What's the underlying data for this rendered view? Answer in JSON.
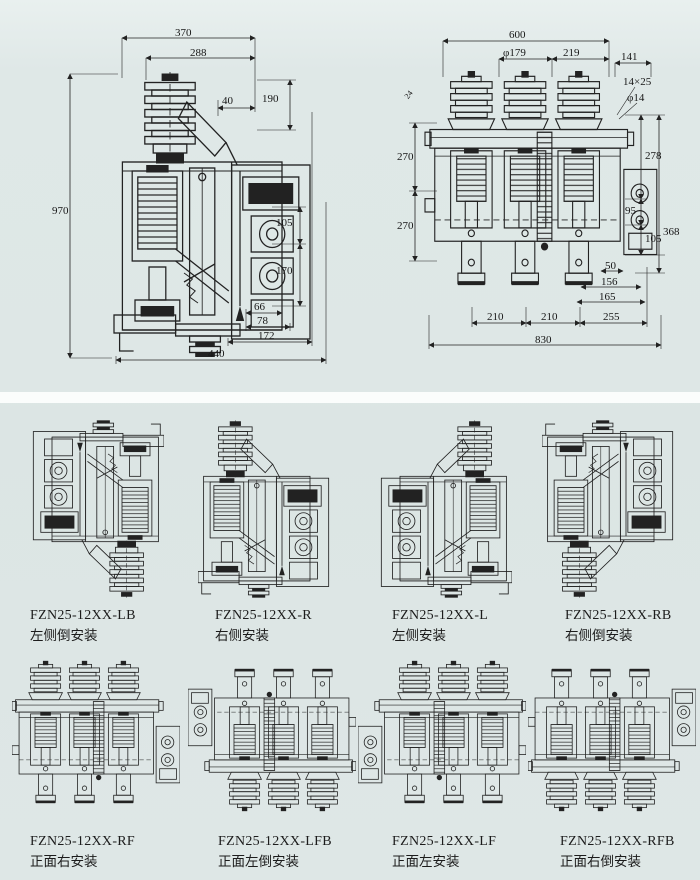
{
  "page": {
    "kind": "switchgear overall and mounting dimensions drawing"
  },
  "colors": {
    "background": "#dee7e6",
    "divider": "#fbfdfc",
    "line": "#222222"
  },
  "top": {
    "left_dims": {
      "a370": "370",
      "a288": "288",
      "a190": "190",
      "a40": "40",
      "a970": "970",
      "a105": "105",
      "a170": "170",
      "a66": "66",
      "a78": "78",
      "a172": "172",
      "a440": "440"
    },
    "right_dims": {
      "a600": "600",
      "a179": "φ179",
      "a219": "219",
      "a141": "141",
      "slot": "14×25",
      "hole": "φ14",
      "a24": "24",
      "a270a": "270",
      "a270b": "270",
      "a278": "278",
      "a95": "95",
      "a105": "105",
      "a368": "368",
      "a50": "50",
      "a156": "156",
      "a165": "165",
      "a210a": "210",
      "a210b": "210",
      "a255": "255",
      "a830": "830"
    }
  },
  "variants": {
    "side": [
      {
        "model": "FZN25-12XX-LB",
        "desc": "左侧倒安装"
      },
      {
        "model": "FZN25-12XX-R",
        "desc": "右侧安装"
      },
      {
        "model": "FZN25-12XX-L",
        "desc": "左侧安装"
      },
      {
        "model": "FZN25-12XX-RB",
        "desc": "右侧倒安装"
      }
    ],
    "front": [
      {
        "model": "FZN25-12XX-RF",
        "desc": "正面右安装"
      },
      {
        "model": "FZN25-12XX-LFB",
        "desc": "正面左倒安装"
      },
      {
        "model": "FZN25-12XX-LF",
        "desc": "正面左安装"
      },
      {
        "model": "FZN25-12XX-RFB",
        "desc": "正面右倒安装"
      }
    ]
  }
}
